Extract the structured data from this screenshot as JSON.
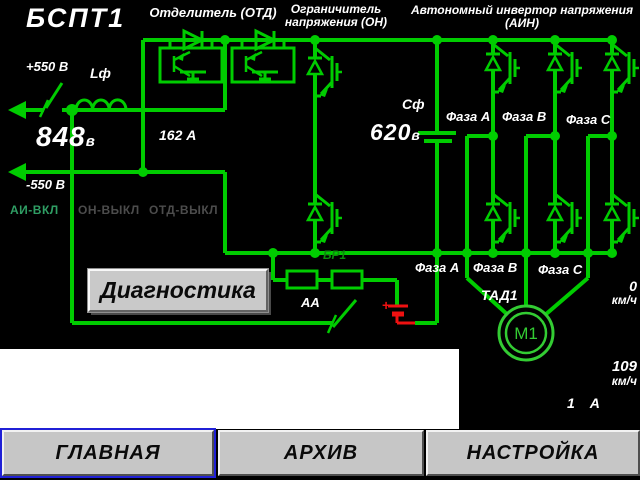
{
  "title": "БСПТ1",
  "sections": {
    "otd": "Отделитель (ОТД)",
    "on_line1": "Ограничитель",
    "on_line2": "напряжения (ОН)",
    "ain_line1": "Автономный инвертор напряжения",
    "ain_line2": "(АИН)"
  },
  "labels": {
    "inductor": "Lф",
    "capacitor": "Сф",
    "resistor_block": "БР1",
    "battery_switch": "АА",
    "motor_group": "ТАД1",
    "motor": "М1",
    "battery_plus": "+"
  },
  "measurements": {
    "supply_plus": "+550 В",
    "supply_minus": "-550 В",
    "input_voltage": {
      "value": "848",
      "unit": "в"
    },
    "input_current": "162 А",
    "dc_link_voltage": {
      "value": "620",
      "unit": "в"
    },
    "speed_actual": {
      "value": "0",
      "unit": "км/ч"
    },
    "speed_reference": {
      "value": "109",
      "unit": "км/ч"
    },
    "motor_current": {
      "value": "1",
      "unit": "А"
    }
  },
  "phases_top": {
    "a": "Фаза А",
    "b": "Фаза В",
    "c": "Фаза С"
  },
  "phases_bottom": {
    "a": "Фаза А",
    "b": "Фаза В",
    "c": "Фаза С"
  },
  "status": {
    "ai": {
      "label": "АИ-ВКЛ",
      "color": "#2f9e64"
    },
    "on": {
      "label": "ОН-ВЫКЛ",
      "color": "#4c4c4c"
    },
    "otd": {
      "label": "ОТД-ВЫКЛ",
      "color": "#4c4c4c"
    }
  },
  "buttons": {
    "diagnostics": "Диагностика",
    "main": "ГЛАВНАЯ",
    "archive": "АРХИВ",
    "settings": "НАСТРОЙКА"
  },
  "colors": {
    "line_green": "#00cc00",
    "motor_green": "#33cc33",
    "dim_green": "#0c8a0c",
    "battery_red": "#ee1111",
    "focus_blue": "#2020d6"
  }
}
